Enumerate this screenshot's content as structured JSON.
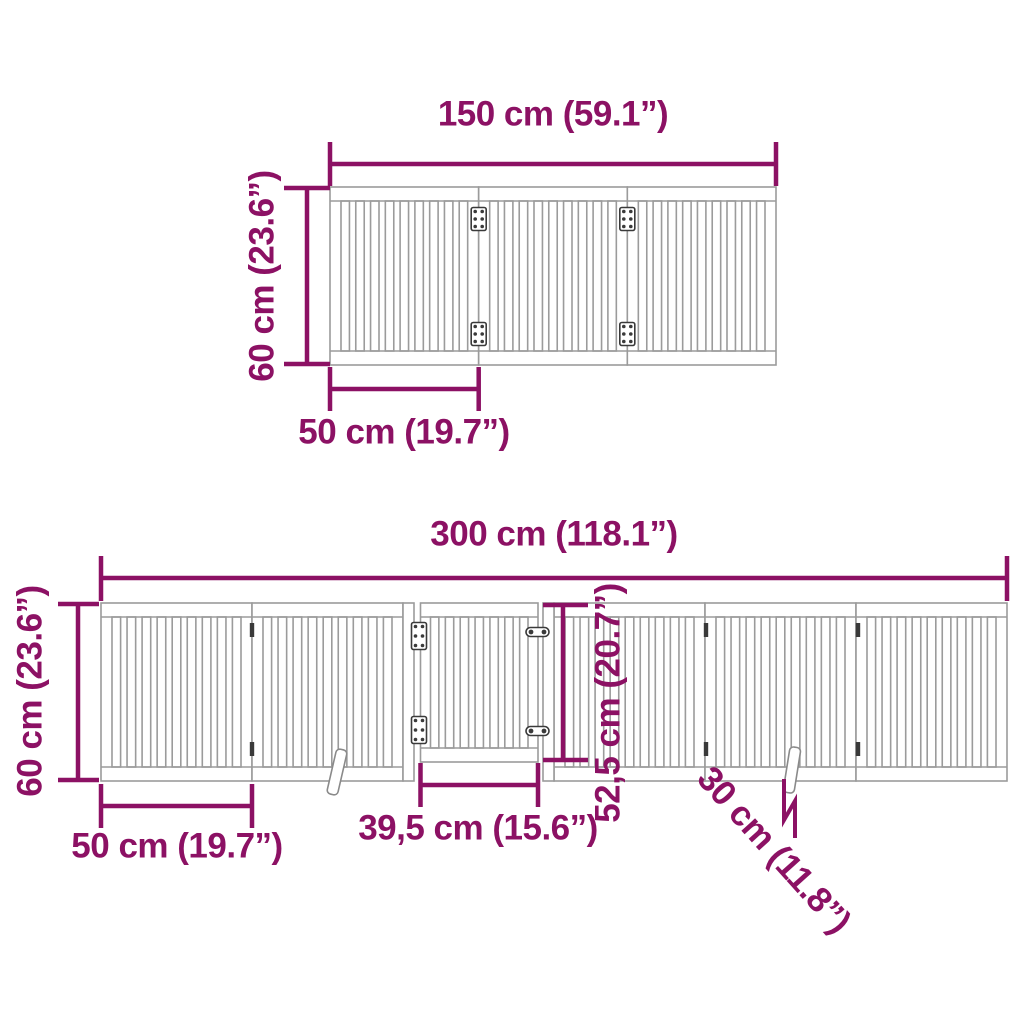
{
  "colors": {
    "dimension": "#8c1164",
    "outline": "#9b9b9b",
    "hardware": "#3a3a3a",
    "foot_outline": "#8a8a8a"
  },
  "top_diagram": {
    "panel_count": 3,
    "width_label": "150 cm (59.1”)",
    "height_label": "60 cm (23.6”)",
    "panel_width_label": "50 cm (19.7”)"
  },
  "bottom_diagram": {
    "panel_count": 6,
    "has_door": true,
    "width_label": "300 cm (118.1”)",
    "height_label": "60 cm (23.6”)",
    "panel_width_label": "50 cm (19.7”)",
    "door_width_label": "39,5 cm (15.6”)",
    "door_height_label": "52,5 cm (20.7”)",
    "support_foot_label": "30 cm (11.8”)"
  }
}
